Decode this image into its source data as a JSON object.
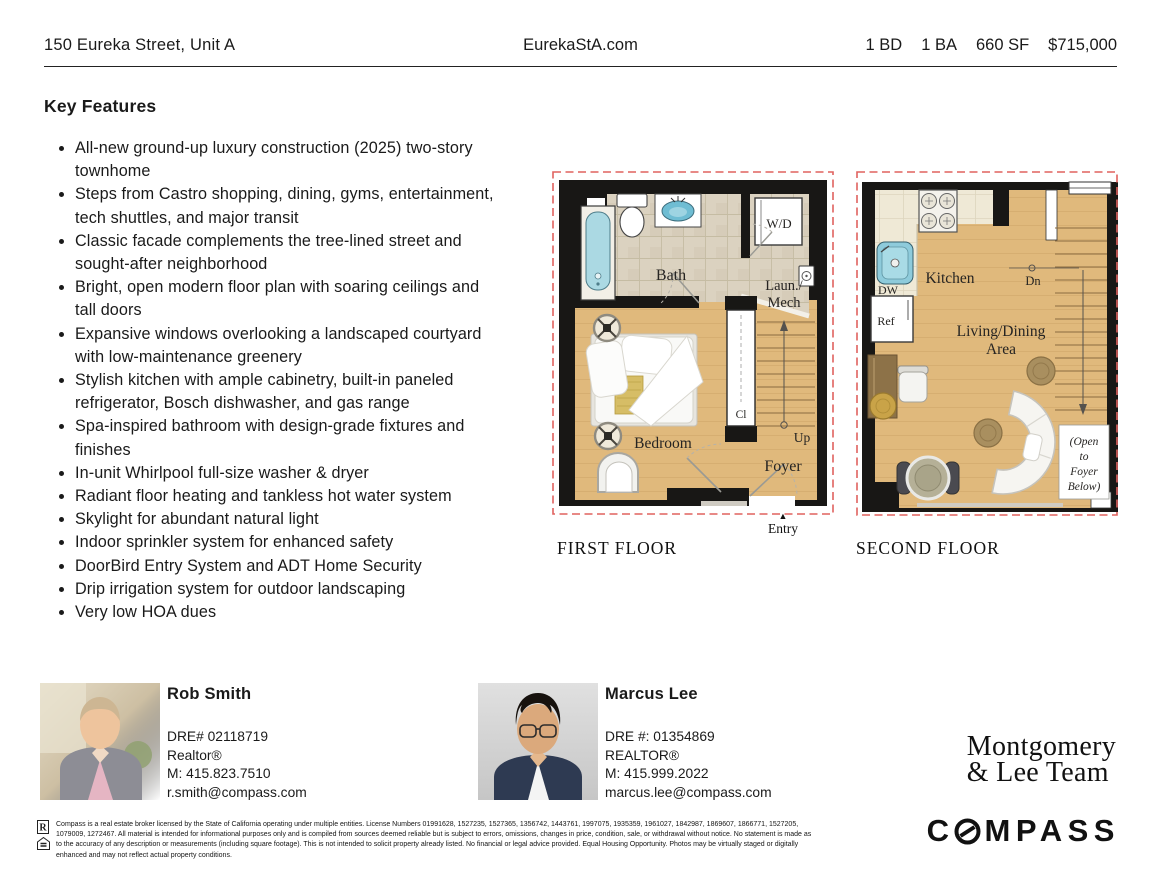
{
  "palette": {
    "accent_red": "#e0625f",
    "wall_black": "#181715",
    "wood_floor": "#e0b97c",
    "bath_tile": "#dbd2c0",
    "kitchen_tile": "#efe9d6",
    "water_blue": "#abd9e3",
    "gold_accent": "#d6bd66"
  },
  "header": {
    "address": "150 Eureka Street, Unit A",
    "website": "EurekaStA.com",
    "stats": [
      "1 BD",
      "1 BA",
      "660 SF",
      "$715,000"
    ]
  },
  "features": {
    "title": "Key Features",
    "items": [
      "All-new ground-up luxury construction (2025) two-story townhome",
      "Steps from Castro shopping, dining, gyms, entertainment, tech shuttles, and major transit",
      "Classic facade complements the tree-lined street and sought-after neighborhood",
      "Bright, open modern floor plan with soaring ceilings and tall doors",
      "Expansive windows overlooking a landscaped courtyard with low-maintenance greenery",
      "Stylish kitchen with ample cabinetry, built-in paneled refrigerator, Bosch dishwasher, and gas range",
      "Spa-inspired bathroom with design-grade fixtures and finishes",
      "In-unit Whirlpool full-size washer & dryer",
      "Radiant floor heating and tankless hot water system",
      "Skylight for abundant natural light",
      "Indoor sprinkler system for enhanced safety",
      "DoorBird Entry System and ADT Home Security",
      "Drip irrigation system for outdoor landscaping",
      "Very low HOA dues"
    ]
  },
  "floorplans": {
    "first": {
      "caption": "FIRST FLOOR",
      "entry_label": "Entry",
      "labels": {
        "bath": "Bath",
        "wd": "W/D",
        "laun1": "Laun./",
        "laun2": "Mech",
        "cl": "Cl",
        "up": "Up",
        "foyer": "Foyer",
        "bedroom": "Bedroom"
      }
    },
    "second": {
      "caption": "SECOND FLOOR",
      "labels": {
        "kitchen": "Kitchen",
        "dw": "DW",
        "ref": "Ref",
        "dn": "Dn",
        "living1": "Living/Dining",
        "living2": "Area",
        "open1": "(Open",
        "open2": "to",
        "open3": "Foyer",
        "open4": "Below)"
      }
    }
  },
  "agents": [
    {
      "name": "Rob Smith",
      "dre": "DRE# 02118719",
      "title": "Realtor®",
      "phone": "M: 415.823.7510",
      "email": "r.smith@compass.com"
    },
    {
      "name": "Marcus Lee",
      "dre": "DRE #: 01354869",
      "title": "REALTOR®",
      "phone": "M: 415.999.2022",
      "email": "marcus.lee@compass.com"
    }
  ],
  "branding": {
    "team_line1": "Montgomery",
    "team_line2": "& Lee Team",
    "brokerage": "COMPASS",
    "brokerage_prefix": "C",
    "brokerage_suffix": "MPASS",
    "realtor_icon_letter": "R"
  },
  "disclaimer": "Compass is a real estate broker licensed by the State of California operating under multiple entities. License Numbers 01991628, 1527235, 1527365, 1356742, 1443761, 1997075, 1935359, 1961027, 1842987, 1869607, 1866771, 1527205, 1079009, 1272467. All material is intended for informational purposes only and is compiled from sources deemed reliable but is subject to errors, omissions, changes in price, condition, sale, or withdrawal without notice. No statement is made as to the accuracy of any description or measurements (including square footage). This is not intended to solicit property already listed. No financial or legal advice provided. Equal Housing Opportunity. Photos may be virtually staged or digitally enhanced and may not reflect actual property conditions."
}
